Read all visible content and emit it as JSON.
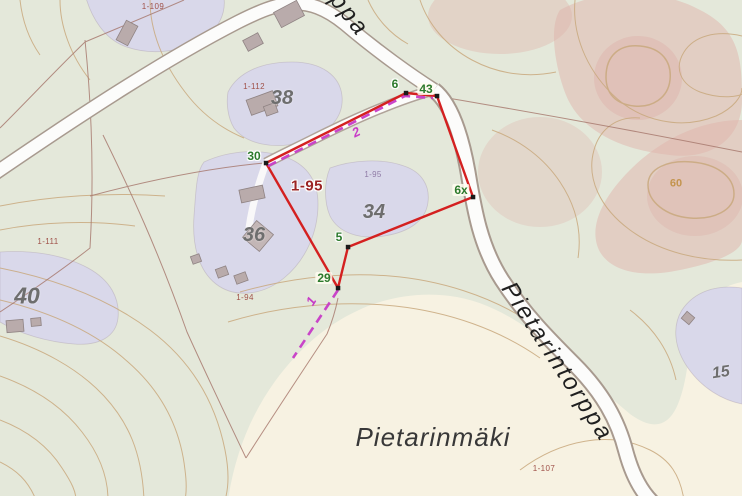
{
  "map": {
    "kind": "topographic cadastral map",
    "colors": {
      "focus_boundary_red": "#d42020",
      "guide_magenta": "#c73bc7",
      "vertex_label_green": "#2c7a2c",
      "parcel_label_red": "#9b2424",
      "terrain_sage": "#e4e8da",
      "field_cream": "#f7f2e2",
      "yard_lavender": "#d9d8ea",
      "rock_pink": "#dfb3ab",
      "contour_tan": "#c9a97e"
    },
    "labels": {
      "place": {
        "text": "Pietarinmäki"
      },
      "road_top": {
        "text": "Pietarintorppa"
      },
      "road_bottom": {
        "text": "Pietarintorppa"
      },
      "focus_parcel": {
        "text": "1-95"
      },
      "focus_parcel_small": {
        "text": "1-95"
      },
      "contour_60": {
        "text": "60"
      },
      "guide_1": {
        "text": "1"
      },
      "guide_2": {
        "text": "2"
      }
    },
    "vertices": {
      "v30": {
        "text": "30"
      },
      "v6": {
        "text": "6"
      },
      "v43": {
        "text": "43"
      },
      "v6x": {
        "text": "6x"
      },
      "v5": {
        "text": "5"
      },
      "v29": {
        "text": "29"
      }
    },
    "parcel_ids": {
      "p109": {
        "text": "1-109"
      },
      "p112": {
        "text": "1-112"
      },
      "p111": {
        "text": "1-111"
      },
      "p94": {
        "text": "1-94"
      },
      "p107": {
        "text": "1-107"
      }
    },
    "house_numbers": {
      "h38": {
        "text": "38"
      },
      "h34": {
        "text": "34"
      },
      "h36": {
        "text": "36"
      },
      "h40": {
        "text": "40"
      },
      "h15": {
        "text": "15"
      }
    }
  }
}
